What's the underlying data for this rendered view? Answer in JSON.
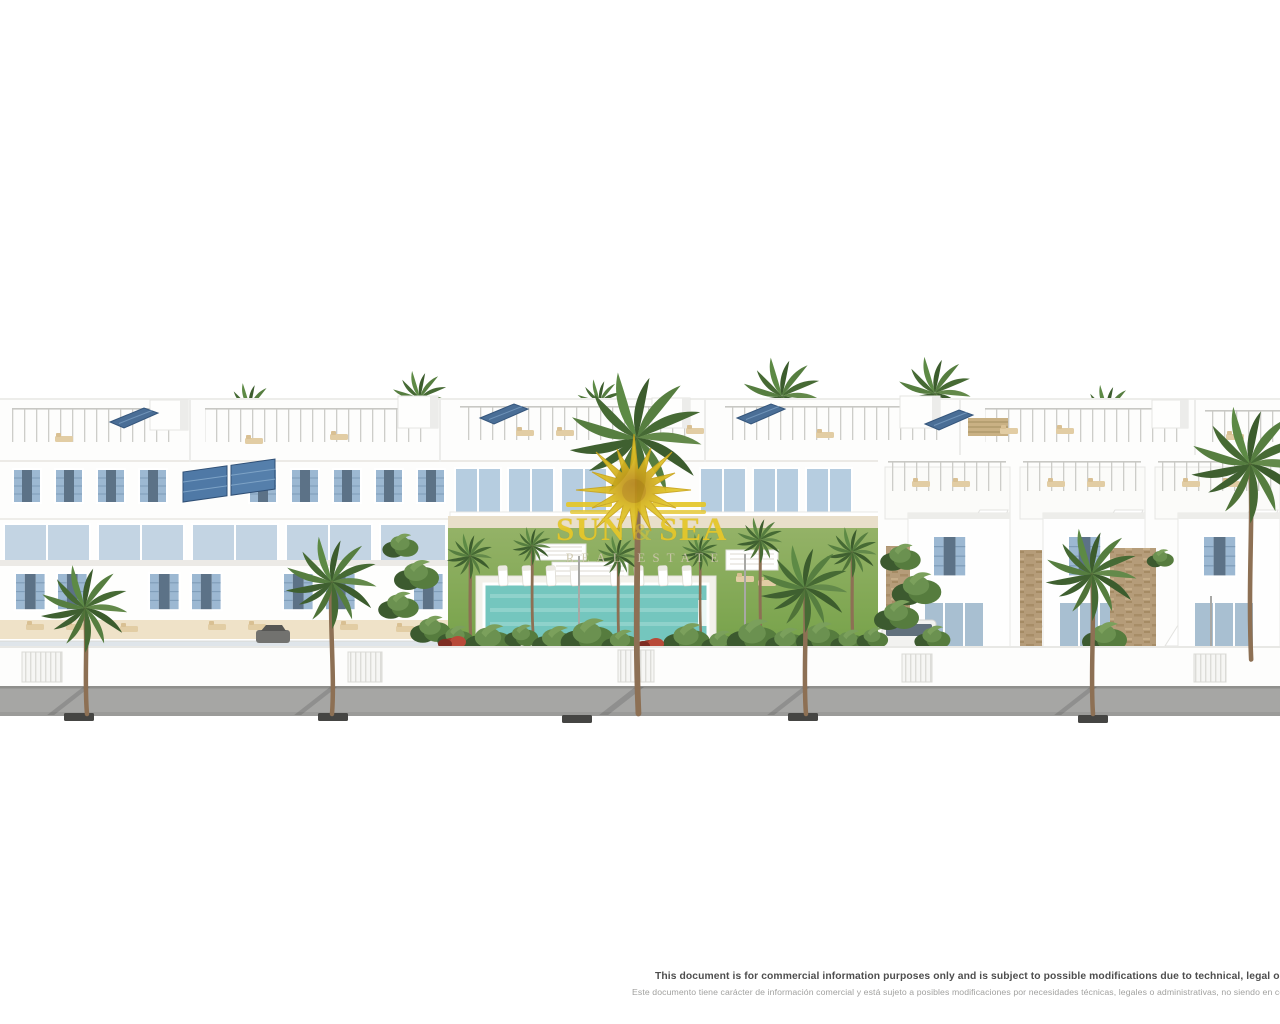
{
  "watermark": {
    "word_left": "SUN",
    "ampersand": "&",
    "word_right": "SEA",
    "tagline": "REAL ESTATE",
    "color": "#e5c72b"
  },
  "footer": {
    "disclaimer_en": "This document is for commercial information purposes only and is subject to possible modifications due to technical, legal or administrative reasons",
    "disclaimer_es": "Este documento tiene carácter de información comercial y está sujeto a posibles modificaciones por necesidades técnicas, legales o administrativas, no siendo en contrato"
  },
  "colors": {
    "sun_yellow": "#e5c72b",
    "pool_water": "#74c6be",
    "pool_light": "#9bd8d1",
    "lawn_green": "#7ba450",
    "shutter_blue": "#9cb8d2",
    "glazing_blue": "#b6cde0",
    "solar_blue": "#4a6e96",
    "palm_green": "#466a34",
    "trunk_brown": "#8d7054",
    "street_gray": "#a6a6a4",
    "stone_tan": "#b59c79",
    "text_dark": "#4e4e4e",
    "text_light": "#a1a19f"
  }
}
